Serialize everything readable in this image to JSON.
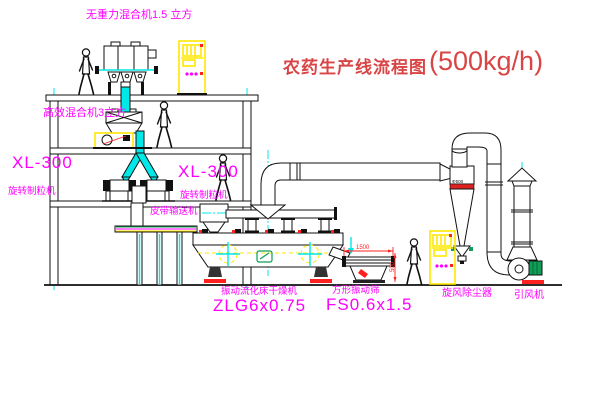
{
  "title": {
    "text_cn": "农药生产线流程图",
    "capacity": "(500kg/h)"
  },
  "labels": {
    "top_mixer": "无重力混合机1.5 立方",
    "second_mixer": "高效混合机3立方",
    "granulator_left_model": "XL-300",
    "granulator_left_name": "旋转制粒机",
    "granulator_mid_model": "XL-300",
    "granulator_mid_name": "旋转制粒机",
    "belt_conveyor": "皮带输送机",
    "dryer_name": "振动流化床干燥机",
    "dryer_model": "ZLG6x0.75",
    "screen_name": "方形振动筛",
    "screen_model": "FS0.6x1.5",
    "cyclone": "旋风除尘器",
    "fan": "引风机"
  },
  "dimensions": {
    "screen_width": "1500",
    "screen_height": "500",
    "cyclone_tag": "Φ500"
  },
  "colors": {
    "label_magenta": "#ff00ff",
    "title_red": "#d94545",
    "centerline_cyan": "#00e8e8",
    "highlight_yellow": "#ffe800",
    "motor_green": "#0f9d58",
    "dimension_red": "#ff2020"
  }
}
